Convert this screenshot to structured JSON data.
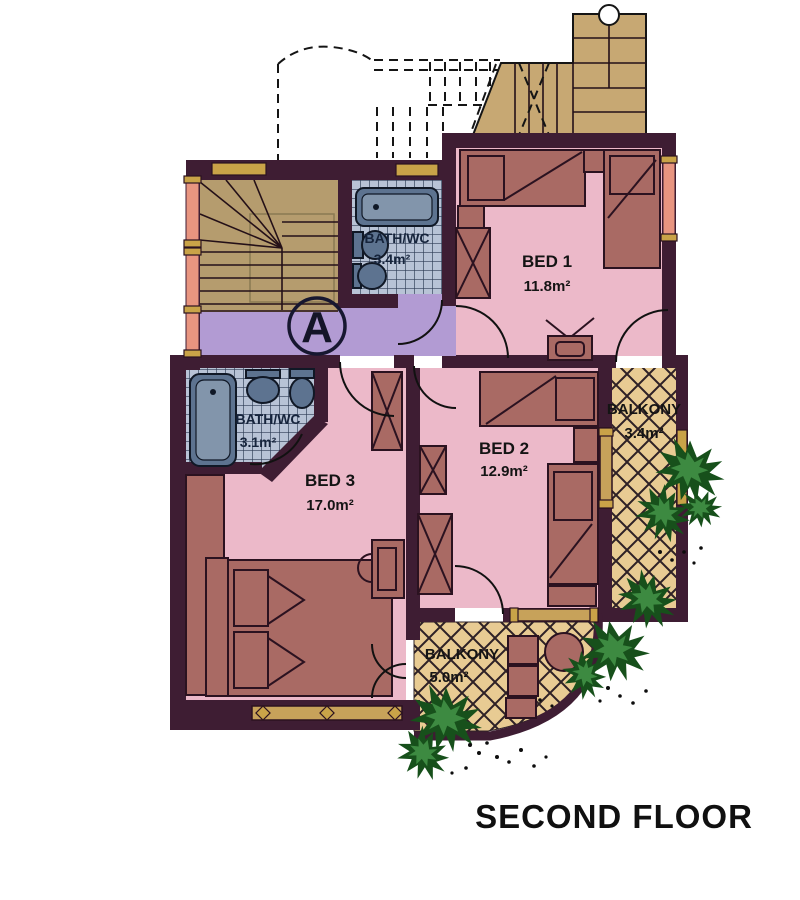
{
  "title": "SECOND FLOOR",
  "section_marker": "A",
  "rooms": {
    "bed1": {
      "name": "BED 1",
      "area": "11.8m²"
    },
    "bed2": {
      "name": "BED 2",
      "area": "12.9m²"
    },
    "bed3": {
      "name": "BED 3",
      "area": "17.0m²"
    },
    "bath_top": {
      "name": "BATH/WC",
      "area": "3.4m²"
    },
    "bath_left": {
      "name": "BATH/WC",
      "area": "3.1m²"
    },
    "balcony_right": {
      "name": "BALKONY",
      "area": "3.4m²"
    },
    "balcony_bottom": {
      "name": "BALKONY",
      "area": "5.0m²"
    }
  },
  "colors": {
    "wall": "#3E1D33",
    "room_pink": "#ECB9C9",
    "hall_purple": "#B29BD3",
    "stair_tan": "#B59C6E",
    "external_stair_tan": "#C7A873",
    "balcony_tan": "#E8CB93",
    "tile_blue": "#B8C3D6",
    "fixture_blue": "#5D7390",
    "furniture_rose": "#A96A64",
    "window_salmon": "#E89580",
    "window_gold": "#C9A348",
    "plant_green": "#17501B",
    "text": "#141414"
  }
}
